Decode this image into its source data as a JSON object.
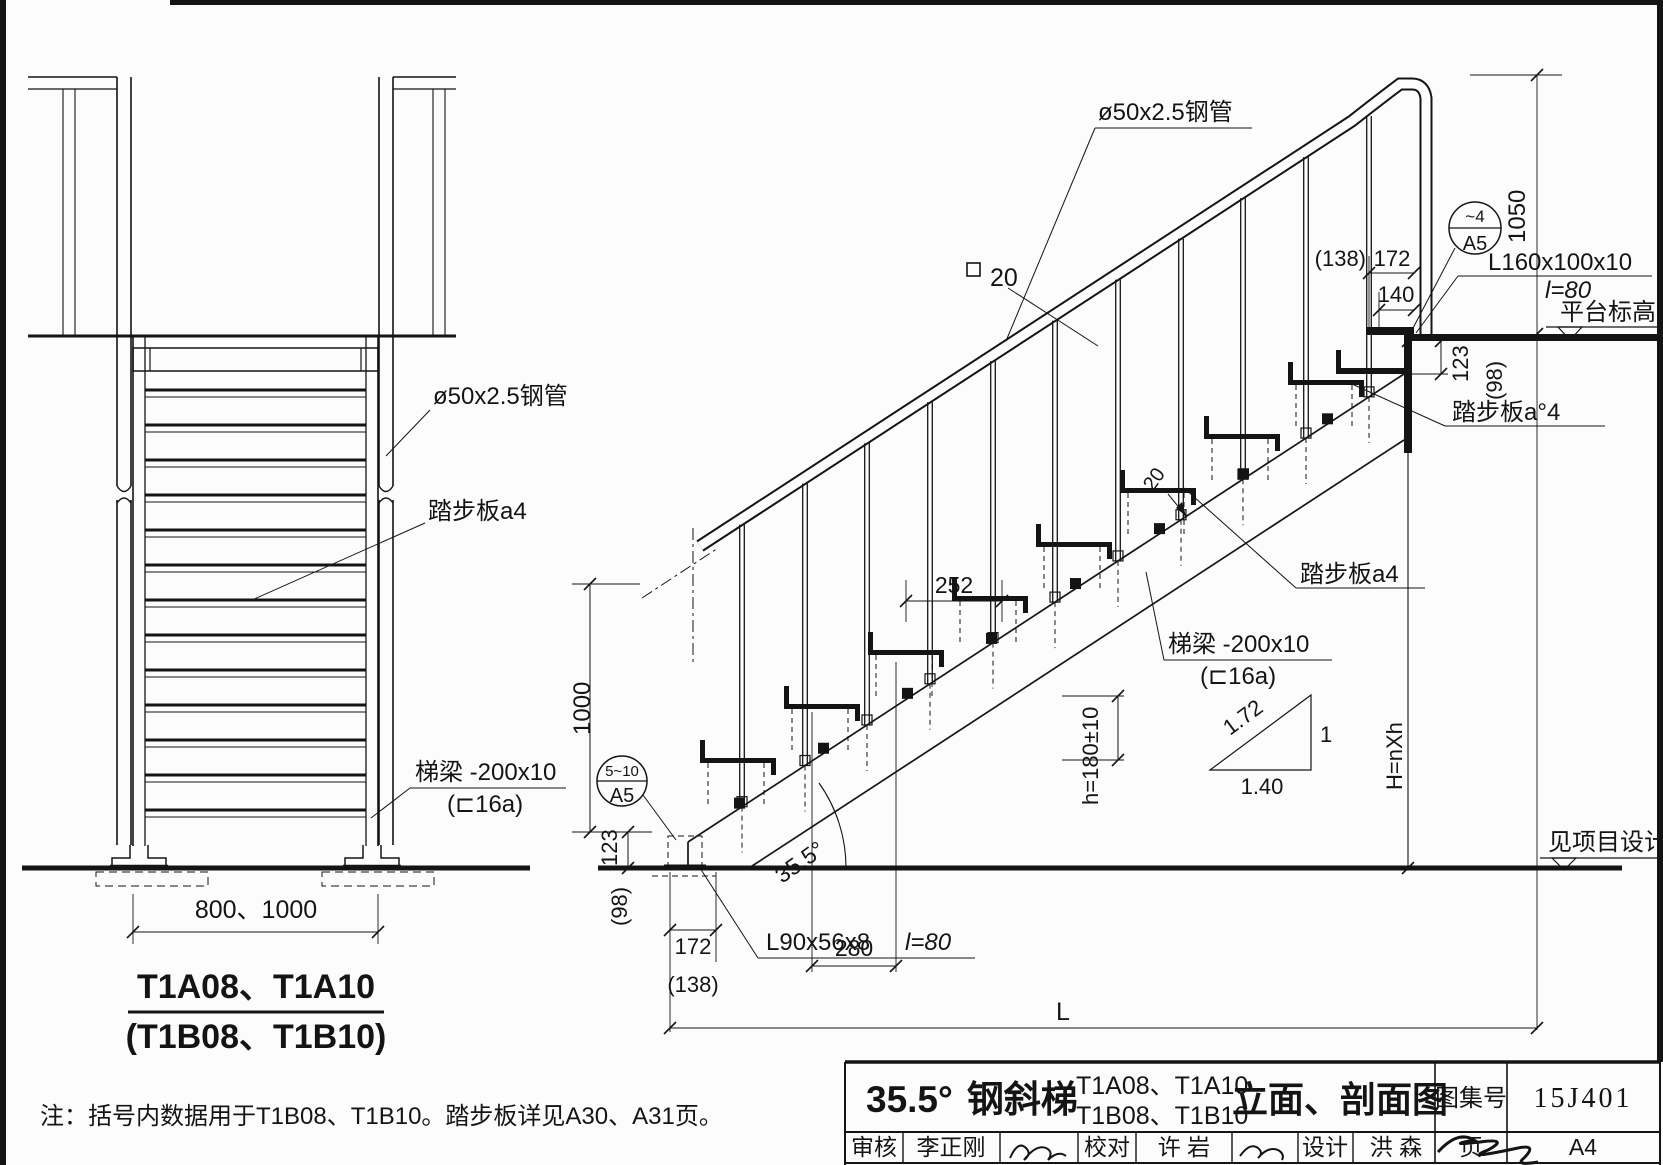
{
  "titleblock": {
    "angle": "35.5°",
    "product": "钢斜梯",
    "models_line1": "T1A08、T1A10",
    "models_line2": "T1B08、T1B10",
    "sheet_type": "立面、剖面图",
    "atlas_label": "图集号",
    "atlas_no": "15J401",
    "page_label": "页",
    "page_no": "A4",
    "review_label": "审核",
    "review_name": "李正刚",
    "check_label": "校对",
    "check_name": "许 岩",
    "design_label": "设计",
    "design_name": "洪 森"
  },
  "front_view": {
    "pipe_label": "ø50x2.5钢管",
    "tread_label": "踏步板a4",
    "beam_label": "梯梁 -200x10",
    "beam_label2": "(⊏16a)",
    "width_dim": "800、1000",
    "title_line1": "T1A08、T1A10",
    "title_line2": "(T1B08、T1B10)"
  },
  "side_view": {
    "pipe_label": "ø50x2.5钢管",
    "square_bar_size": "20",
    "dim_1050": "1050",
    "weld_top": "~4",
    "weld_top_ref": "A5",
    "dim_138": "(138)",
    "dim_172": "172",
    "dim_140": "140",
    "angle_cleat": "L160x100x10",
    "angle_cleat_len": "l=80",
    "platform_level_label": "平台标高",
    "dim_123_top": "123",
    "dim_98_top": "(98)",
    "tread_label_top": "踏步板a°4",
    "tread_label_mid": "踏步板a4",
    "beam_label": "梯梁 -200x10",
    "beam_label2": "(⊏16a)",
    "dim_252": "252",
    "dim_280": "280",
    "dim_riser": "h=180±10",
    "slope_angle": "35.5°",
    "dim_20": "20",
    "dim_1000": "1000",
    "weld_bottom": "5~10",
    "weld_bottom_ref": "A5",
    "dim_123_bottom": "123",
    "dim_98_bottom": "(98)",
    "dim_172_bottom": "172",
    "dim_138_bottom": "(138)",
    "base_cleat": "L90x56x8",
    "base_cleat_len": "l=80",
    "dim_span": "L",
    "height_formula": "H=nXh",
    "slope_hyp": "1.72",
    "slope_v": "1",
    "slope_h": "1.40",
    "ground_level_label": "见项目设计"
  },
  "note": "注：括号内数据用于T1B08、T1B10。踏步板详见A30、A31页。"
}
